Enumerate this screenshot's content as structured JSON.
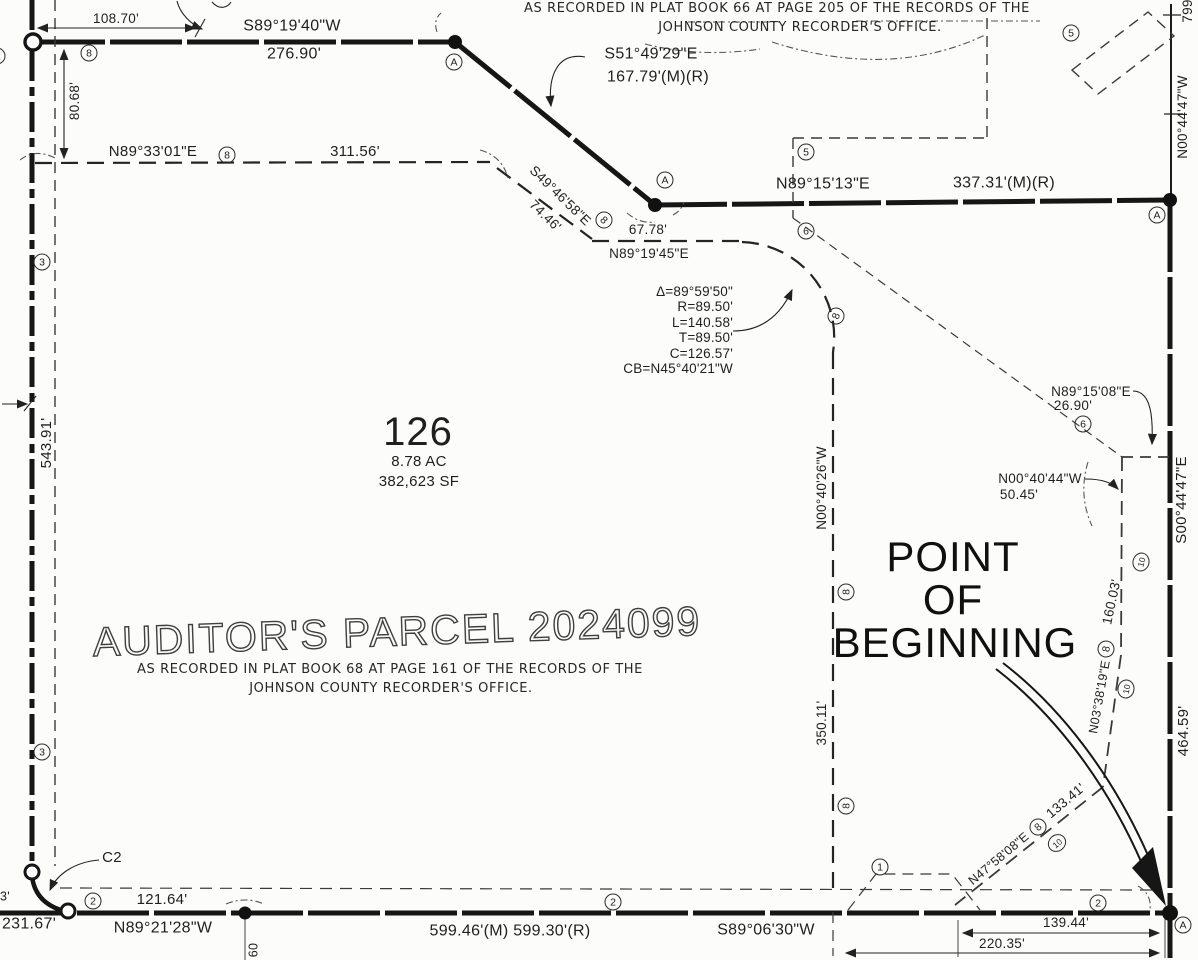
{
  "notes_top": {
    "line1": "AS RECORDED IN PLAT BOOK 66 AT PAGE 205 OF THE RECORDS OF THE",
    "line2": "JOHNSON COUNTY RECORDER'S OFFICE."
  },
  "parcel": {
    "number": "126",
    "acres": "8.78 AC",
    "area_sf": "382,623 SF",
    "title": "AUDITOR'S PARCEL 2024099",
    "recorded_line1": "AS RECORDED IN PLAT BOOK 68 AT PAGE 161 OF THE RECORDS OF THE",
    "recorded_line2": "JOHNSON COUNTY RECORDER'S OFFICE."
  },
  "pob": {
    "line1": "POINT",
    "line2": "OF",
    "line3": "BEGINNING"
  },
  "curve_table": {
    "delta": "Δ=89°59'50\"",
    "radius": "R=89.50'",
    "arc_length": "L=140.58'",
    "tangent": "T=89.50'",
    "chord": "C=126.57'",
    "chord_bearing": "CB=N45°40'21\"W"
  },
  "curve_label": "C2",
  "bearings": {
    "s891940": "S89°19'40\"W",
    "s514929": "S51°49'29\"E",
    "n893301": "N89°33'01\"E",
    "s494658": "S49°46'58\"E",
    "n891945": "N89°19'45\"E",
    "n891513": "N89°15'13\"E",
    "n004026": "N00°40'26\"W",
    "n891508": "N89°15'08\"E",
    "n004044": "N00°40'44\"W",
    "s004447": "S00°44'47\"E",
    "n004447": "N00°44'47\"W",
    "n033819": "N03°38'19\"E",
    "n475808": "N47°58'08\"E",
    "n892128": "N89°21'28\"W",
    "s890630": "S89°06'30\"W"
  },
  "distances": {
    "d10870": "108.70'",
    "d27690": "276.90'",
    "d16779": "167.79'(M)(R)",
    "d8068": "80.68'",
    "d31156": "311.56'",
    "d7446": "74.46'",
    "d6778": "67.78'",
    "d33731": "337.31'(M)(R)",
    "d54391": "543.91'",
    "d35011": "350.11'",
    "d2690": "26.90'",
    "d5045": "50.45'",
    "d799": "799",
    "d46459": "464.59'",
    "d16003": "160.03'",
    "d13341": "133.41'",
    "d12164": "121.64'",
    "d23167": "231.67'",
    "d59946": "599.46'(M) 599.30'(R)",
    "d13944": "139.44'",
    "d22035": "220.35'",
    "d60": "60",
    "frag3": "3'"
  },
  "circled": {
    "one": "1",
    "two": "2",
    "three": "3",
    "five": "5",
    "six": "6",
    "eight": "8",
    "ten": "10",
    "a": "A"
  },
  "colors": {
    "ink": "#1f1f1f",
    "paper": "#fcfcfa"
  }
}
